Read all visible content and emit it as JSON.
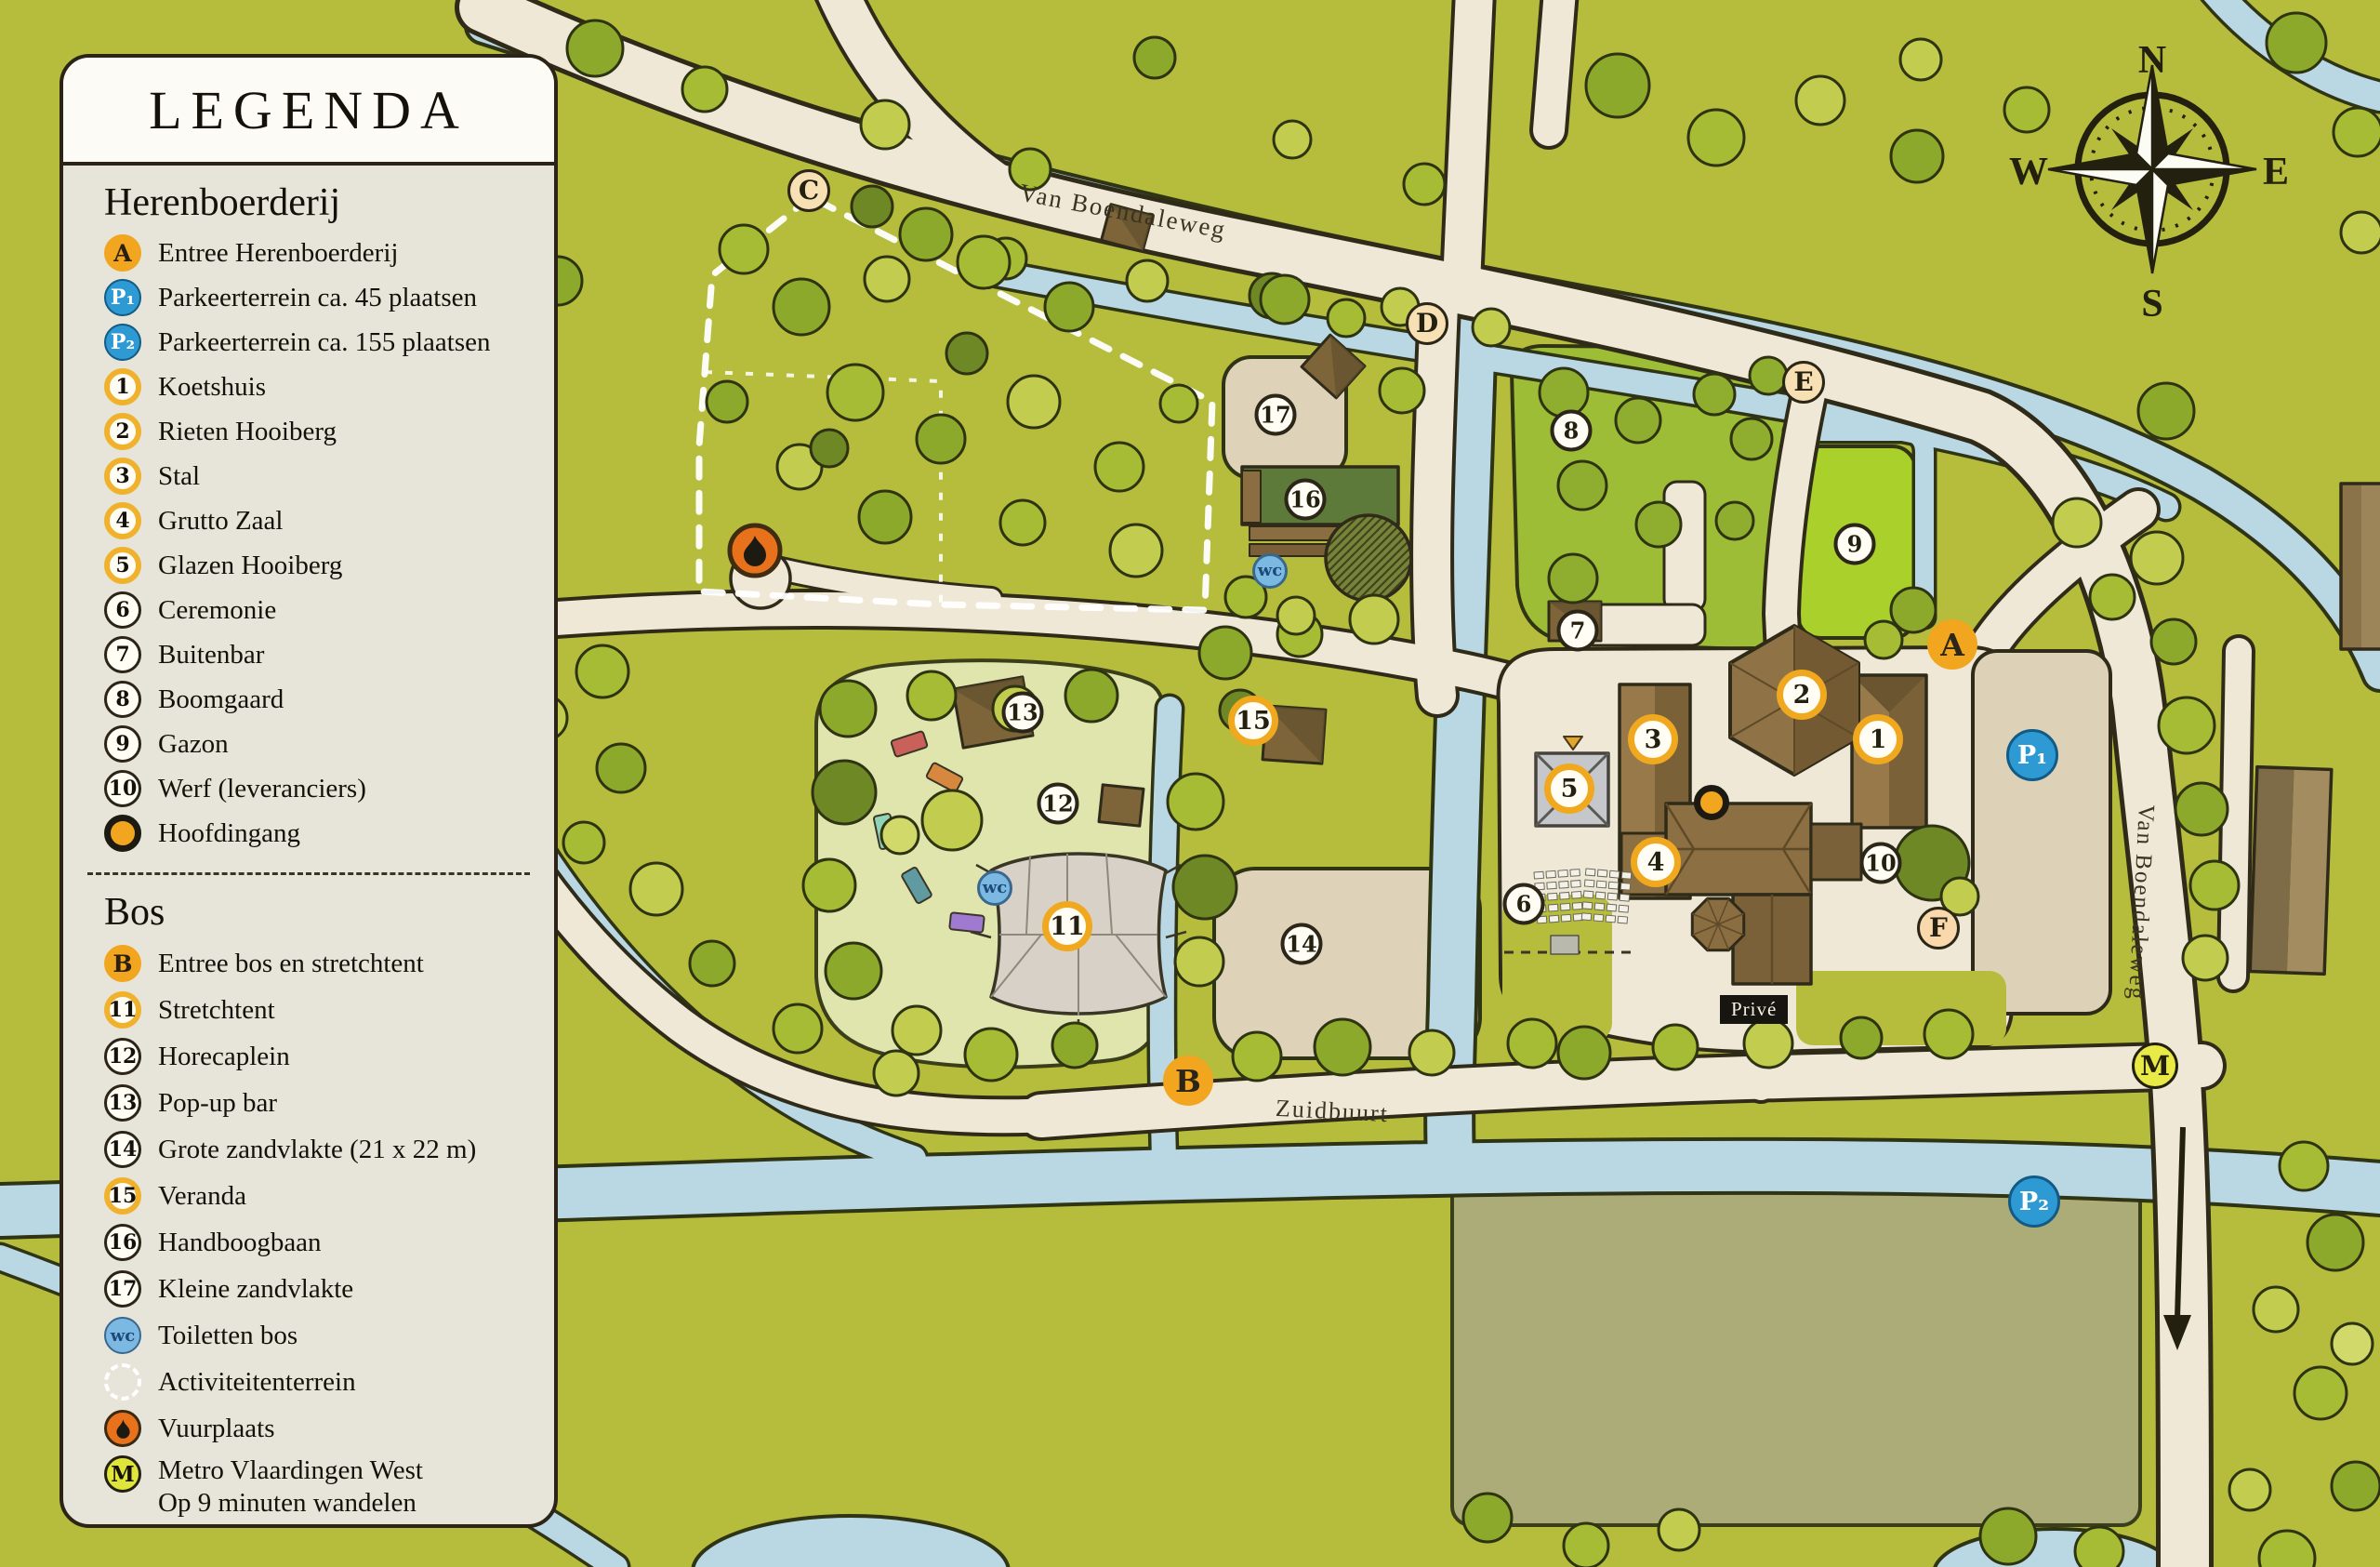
{
  "legend": {
    "title": "LEGENDA",
    "herenboerderij": {
      "heading": "Herenboerderij",
      "items": [
        {
          "icon": "A",
          "label": "Entree Herenboerderij"
        },
        {
          "icon": "P₁",
          "label": "Parkeerterrein ca. 45 plaatsen"
        },
        {
          "icon": "P₂",
          "label": "Parkeerterrein ca. 155 plaatsen"
        },
        {
          "icon": "1",
          "label": "Koetshuis"
        },
        {
          "icon": "2",
          "label": "Rieten Hooiberg"
        },
        {
          "icon": "3",
          "label": "Stal"
        },
        {
          "icon": "4",
          "label": "Grutto Zaal"
        },
        {
          "icon": "5",
          "label": "Glazen Hooiberg"
        },
        {
          "icon": "6",
          "label": "Ceremonie"
        },
        {
          "icon": "7",
          "label": "Buitenbar"
        },
        {
          "icon": "8",
          "label": "Boomgaard"
        },
        {
          "icon": "9",
          "label": "Gazon"
        },
        {
          "icon": "10",
          "label": "Werf (leveranciers)"
        },
        {
          "icon": "",
          "label": "Hoofdingang"
        }
      ]
    },
    "bos": {
      "heading": "Bos",
      "items": [
        {
          "icon": "B",
          "label": "Entree bos en stretchtent"
        },
        {
          "icon": "11",
          "label": "Stretchtent"
        },
        {
          "icon": "12",
          "label": "Horecaplein"
        },
        {
          "icon": "13",
          "label": "Pop-up bar"
        },
        {
          "icon": "14",
          "label": "Grote zandvlakte (21 x 22 m)"
        },
        {
          "icon": "15",
          "label": "Veranda"
        },
        {
          "icon": "16",
          "label": "Handboogbaan"
        },
        {
          "icon": "17",
          "label": "Kleine zandvlakte"
        },
        {
          "icon": "wc",
          "label": "Toiletten bos"
        },
        {
          "icon": "",
          "label": "Activiteitenterrein"
        },
        {
          "icon": "",
          "label": "Vuurplaats"
        },
        {
          "icon": "M",
          "label": "Metro Vlaardingen West",
          "sublabel": "Op 9 minuten wandelen"
        }
      ]
    }
  },
  "map": {
    "roads": {
      "van_boendaleweg_top": "Van Boendaleweg",
      "van_boendaleweg_right": "Van Boendaleweg",
      "zuidbuurt": "Zuidbuurt"
    },
    "labels": {
      "prive": "Privé"
    },
    "compass": {
      "n": "N",
      "e": "E",
      "s": "S",
      "w": "W"
    },
    "markers": {
      "a": "A",
      "b": "B",
      "c": "C",
      "d": "D",
      "e": "E",
      "f": "F",
      "m": "M",
      "p1": "P₁",
      "p2": "P₂",
      "wc": "wc",
      "n1": "1",
      "n2": "2",
      "n3": "3",
      "n4": "4",
      "n5": "5",
      "n6": "6",
      "n7": "7",
      "n8": "8",
      "n9": "9",
      "n10": "10",
      "n11": "11",
      "n12": "12",
      "n13": "13",
      "n14": "14",
      "n15": "15",
      "n16": "16",
      "n17": "17"
    }
  }
}
